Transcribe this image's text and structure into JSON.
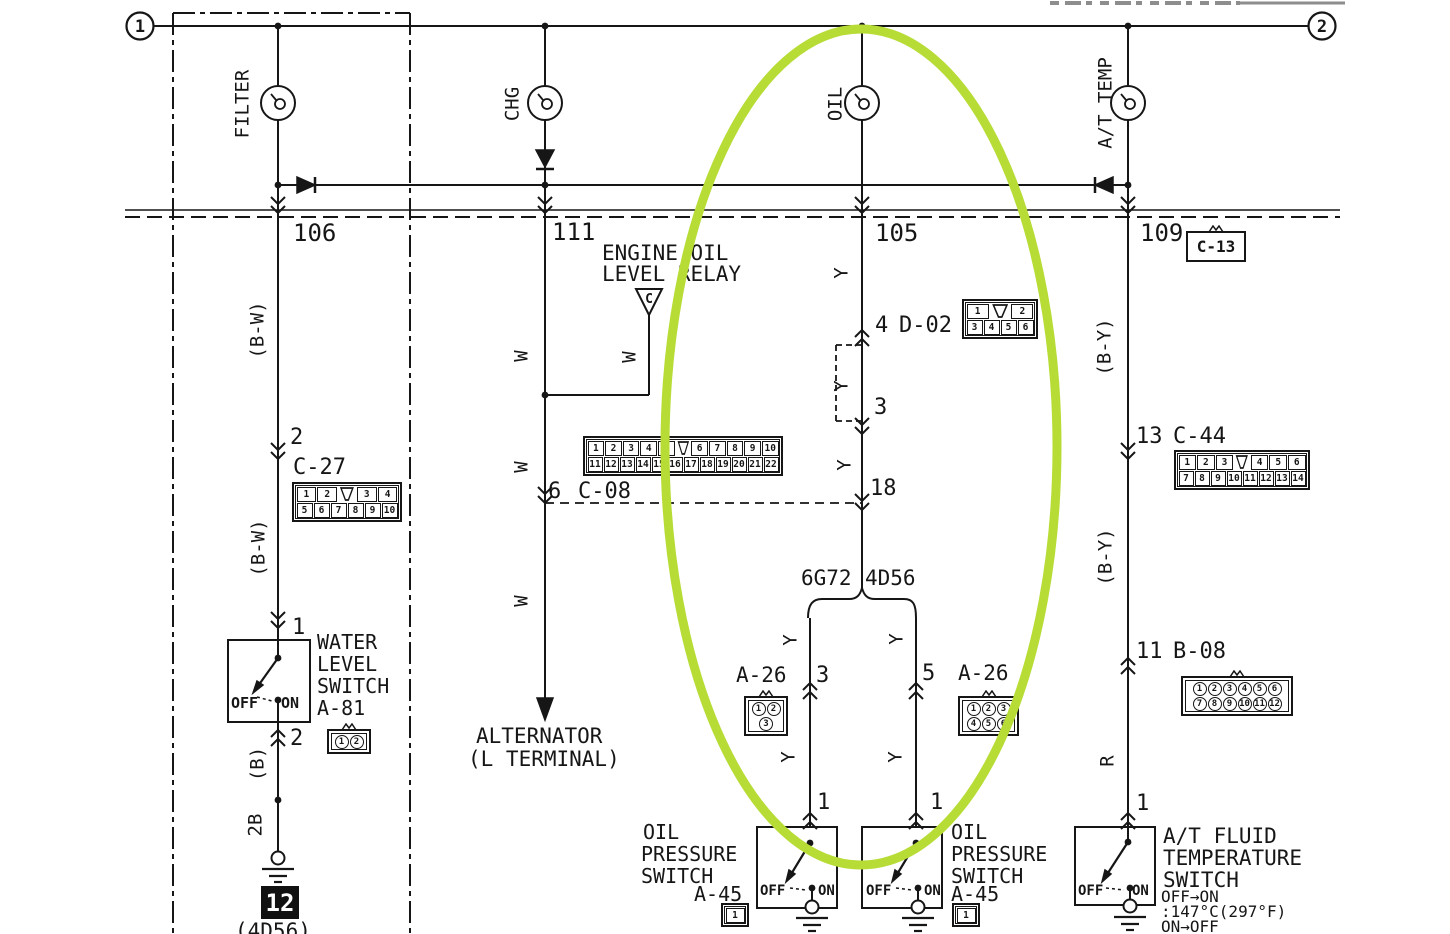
{
  "title": "Gauge circuit wiring diagram (FILTER / CHG / OIL / A-T TEMP indicators)",
  "colors": {
    "ink": "#161616",
    "background": "#ffffff",
    "highlight_green": "#b7dc36",
    "cropped_text_gray": "#8d8d8d"
  },
  "circuit_nodes": {
    "left": "1",
    "right": "2"
  },
  "highlight": {
    "shape": "ellipse",
    "color": "#b7dc36",
    "center_x": 861,
    "center_y": 447,
    "rx": 196,
    "ry": 418
  },
  "ground_ref": {
    "t": "12"
  },
  "labels": [
    {
      "n": "filter-gauge-label",
      "t": "FILTER",
      "x": 243,
      "y": 104,
      "s": 19,
      "rot": 1
    },
    {
      "n": "chg-gauge-label",
      "t": "CHG",
      "x": 513,
      "y": 104,
      "s": 19,
      "rot": 1
    },
    {
      "n": "oil-gauge-label",
      "t": "OIL",
      "x": 836,
      "y": 104,
      "s": 19,
      "rot": 1
    },
    {
      "n": "at-temp-gauge-label",
      "t": "A/T TEMP",
      "x": 1106,
      "y": 103,
      "s": 19,
      "rot": 1
    },
    {
      "n": "bus-pin-106",
      "t": "106",
      "x": 293,
      "y": 221,
      "s": 24
    },
    {
      "n": "bus-pin-111",
      "t": "111",
      "x": 552,
      "y": 220,
      "s": 24
    },
    {
      "n": "bus-pin-105",
      "t": "105",
      "x": 875,
      "y": 221,
      "s": 24
    },
    {
      "n": "bus-pin-109",
      "t": "109",
      "x": 1140,
      "y": 221,
      "s": 24
    },
    {
      "n": "wire-color-bw-upper",
      "t": "(B-W)",
      "x": 258,
      "y": 330,
      "s": 19,
      "rot": 1
    },
    {
      "n": "pin-2-c27",
      "t": "2",
      "x": 290,
      "y": 427,
      "s": 22
    },
    {
      "n": "connector-id-c27",
      "t": "C-27",
      "x": 293,
      "y": 457,
      "s": 22
    },
    {
      "n": "wire-color-bw-lower",
      "t": "(B-W)",
      "x": 259,
      "y": 548,
      "s": 19,
      "rot": 1
    },
    {
      "n": "pin-1-a81",
      "t": "1",
      "x": 292,
      "y": 617,
      "s": 22
    },
    {
      "n": "water-level-switch-name-1",
      "t": "WATER",
      "x": 317,
      "y": 632,
      "s": 20
    },
    {
      "n": "water-level-switch-name-2",
      "t": "LEVEL",
      "x": 317,
      "y": 654,
      "s": 20
    },
    {
      "n": "water-level-switch-name-3",
      "t": "SWITCH",
      "x": 317,
      "y": 676,
      "s": 20
    },
    {
      "n": "water-level-switch-id",
      "t": "A-81",
      "x": 317,
      "y": 698,
      "s": 20
    },
    {
      "n": "water-level-off",
      "t": "OFF",
      "x": 231,
      "y": 696,
      "s": 15,
      "w": 700
    },
    {
      "n": "water-level-on",
      "t": "ON",
      "x": 281,
      "y": 696,
      "s": 15,
      "w": 700
    },
    {
      "n": "pin-2-a81",
      "t": "2",
      "x": 290,
      "y": 728,
      "s": 22
    },
    {
      "n": "wire-color-b",
      "t": "(B)",
      "x": 258,
      "y": 764,
      "s": 19,
      "rot": 1
    },
    {
      "n": "wire-gauge-2b",
      "t": "2B",
      "x": 256,
      "y": 825,
      "s": 19,
      "rot": 1
    },
    {
      "n": "engine-code-4d56-bottom",
      "t": "(4D56)",
      "x": 235,
      "y": 921,
      "s": 21
    },
    {
      "n": "wire-color-w-1",
      "t": "W",
      "x": 522,
      "y": 356,
      "s": 19,
      "rot": 1
    },
    {
      "n": "wire-color-w-2",
      "t": "W",
      "x": 522,
      "y": 467,
      "s": 19,
      "rot": 1
    },
    {
      "n": "wire-color-w-3",
      "t": "W",
      "x": 522,
      "y": 601,
      "s": 19,
      "rot": 1
    },
    {
      "n": "wire-color-w-relay",
      "t": "W",
      "x": 630,
      "y": 357,
      "s": 19,
      "rot": 1
    },
    {
      "n": "engine-oil-level-relay-name-1",
      "t": "ENGINE OIL",
      "x": 602,
      "y": 243,
      "s": 21
    },
    {
      "n": "engine-oil-level-relay-name-2",
      "t": "LEVEL RELAY",
      "x": 602,
      "y": 264,
      "s": 21
    },
    {
      "n": "pin-6-c08",
      "t": "6",
      "x": 548,
      "y": 481,
      "s": 22
    },
    {
      "n": "connector-id-c08",
      "t": "C-08",
      "x": 578,
      "y": 481,
      "s": 22
    },
    {
      "n": "alternator-name-1",
      "t": "ALTERNATOR",
      "x": 476,
      "y": 726,
      "s": 21
    },
    {
      "n": "alternator-name-2",
      "t": "(L TERMINAL)",
      "x": 468,
      "y": 749,
      "s": 21
    },
    {
      "n": "wire-color-y-1",
      "t": "Y",
      "x": 842,
      "y": 273,
      "s": 19,
      "rot": 1
    },
    {
      "n": "pin-4-d02",
      "t": "4",
      "x": 875,
      "y": 315,
      "s": 22
    },
    {
      "n": "connector-id-d02",
      "t": "D-02",
      "x": 899,
      "y": 315,
      "s": 22
    },
    {
      "n": "wire-color-y-2",
      "t": "Y",
      "x": 842,
      "y": 386,
      "s": 19,
      "rot": 1
    },
    {
      "n": "pin-3-d02",
      "t": "3",
      "x": 874,
      "y": 397,
      "s": 22
    },
    {
      "n": "wire-color-y-3",
      "t": "Y",
      "x": 845,
      "y": 465,
      "s": 19,
      "rot": 1
    },
    {
      "n": "pin-18",
      "t": "18",
      "x": 870,
      "y": 478,
      "s": 22
    },
    {
      "n": "engine-code-6g72",
      "t": "6G72",
      "x": 801,
      "y": 568,
      "s": 21
    },
    {
      "n": "engine-code-4d56",
      "t": "4D56",
      "x": 865,
      "y": 568,
      "s": 21
    },
    {
      "n": "wire-color-y-4",
      "t": "Y",
      "x": 791,
      "y": 640,
      "s": 19,
      "rot": 1
    },
    {
      "n": "wire-color-y-5",
      "t": "Y",
      "x": 897,
      "y": 639,
      "s": 19,
      "rot": 1
    },
    {
      "n": "connector-id-a26-left",
      "t": "A-26",
      "x": 736,
      "y": 665,
      "s": 21
    },
    {
      "n": "pin-3-a26",
      "t": "3",
      "x": 816,
      "y": 665,
      "s": 22
    },
    {
      "n": "pin-5-a26",
      "t": "5",
      "x": 922,
      "y": 663,
      "s": 22
    },
    {
      "n": "connector-id-a26-right",
      "t": "A-26",
      "x": 958,
      "y": 663,
      "s": 21
    },
    {
      "n": "wire-color-y-6",
      "t": "Y",
      "x": 789,
      "y": 757,
      "s": 19,
      "rot": 1
    },
    {
      "n": "wire-color-y-7",
      "t": "Y",
      "x": 896,
      "y": 757,
      "s": 19,
      "rot": 1
    },
    {
      "n": "pin-1-oil-switch-left",
      "t": "1",
      "x": 817,
      "y": 792,
      "s": 22
    },
    {
      "n": "pin-1-oil-switch-right",
      "t": "1",
      "x": 930,
      "y": 792,
      "s": 22
    },
    {
      "n": "oil-switch-left-name-1",
      "t": "OIL",
      "x": 643,
      "y": 822,
      "s": 20
    },
    {
      "n": "oil-switch-left-name-2",
      "t": "PRESSURE",
      "x": 641,
      "y": 844,
      "s": 20
    },
    {
      "n": "oil-switch-left-name-3",
      "t": "SWITCH",
      "x": 641,
      "y": 866,
      "s": 20
    },
    {
      "n": "oil-switch-left-id",
      "t": "A-45",
      "x": 694,
      "y": 884,
      "s": 20
    },
    {
      "n": "oil-switch-left-off",
      "t": "OFF",
      "x": 760,
      "y": 884,
      "s": 14,
      "w": 700
    },
    {
      "n": "oil-switch-left-on",
      "t": "ON",
      "x": 818,
      "y": 884,
      "s": 14,
      "w": 700
    },
    {
      "n": "oil-switch-right-off",
      "t": "OFF",
      "x": 866,
      "y": 884,
      "s": 14,
      "w": 700
    },
    {
      "n": "oil-switch-right-on",
      "t": "ON",
      "x": 924,
      "y": 884,
      "s": 14,
      "w": 700
    },
    {
      "n": "oil-switch-right-name-1",
      "t": "OIL",
      "x": 951,
      "y": 822,
      "s": 20
    },
    {
      "n": "oil-switch-right-name-2",
      "t": "PRESSURE",
      "x": 951,
      "y": 844,
      "s": 20
    },
    {
      "n": "oil-switch-right-name-3",
      "t": "SWITCH",
      "x": 951,
      "y": 866,
      "s": 20
    },
    {
      "n": "oil-switch-right-id",
      "t": "A-45",
      "x": 951,
      "y": 884,
      "s": 20
    },
    {
      "n": "wire-color-by-upper",
      "t": "(B-Y)",
      "x": 1105,
      "y": 347,
      "s": 19,
      "rot": 1
    },
    {
      "n": "pin-13-c44",
      "t": "13",
      "x": 1136,
      "y": 426,
      "s": 22
    },
    {
      "n": "connector-id-c44",
      "t": "C-44",
      "x": 1173,
      "y": 426,
      "s": 22
    },
    {
      "n": "wire-color-by-lower",
      "t": "(B-Y)",
      "x": 1106,
      "y": 557,
      "s": 19,
      "rot": 1
    },
    {
      "n": "pin-11-b08",
      "t": "11",
      "x": 1136,
      "y": 641,
      "s": 22
    },
    {
      "n": "connector-id-b08",
      "t": "B-08",
      "x": 1173,
      "y": 641,
      "s": 22
    },
    {
      "n": "wire-color-r",
      "t": "R",
      "x": 1108,
      "y": 761,
      "s": 19,
      "rot": 1
    },
    {
      "n": "pin-1-atf-switch",
      "t": "1",
      "x": 1136,
      "y": 793,
      "s": 22
    },
    {
      "n": "atf-switch-off",
      "t": "OFF",
      "x": 1078,
      "y": 884,
      "s": 14,
      "w": 700
    },
    {
      "n": "atf-switch-on",
      "t": "ON",
      "x": 1132,
      "y": 884,
      "s": 14,
      "w": 700
    },
    {
      "n": "atf-switch-name-1",
      "t": "A/T FLUID",
      "x": 1163,
      "y": 826,
      "s": 21
    },
    {
      "n": "atf-switch-name-2",
      "t": "TEMPERATURE",
      "x": 1163,
      "y": 848,
      "s": 21
    },
    {
      "n": "atf-switch-name-3",
      "t": "SWITCH",
      "x": 1163,
      "y": 870,
      "s": 21
    },
    {
      "n": "atf-switch-note-1",
      "t": "OFF→ON",
      "x": 1161,
      "y": 889,
      "s": 16
    },
    {
      "n": "atf-switch-note-2",
      "t": ":147°C(297°F)",
      "x": 1161,
      "y": 904,
      "s": 16
    },
    {
      "n": "atf-switch-note-3",
      "t": "ON→OFF",
      "x": 1161,
      "y": 919,
      "s": 16
    }
  ],
  "connectors": [
    {
      "name": "C-27",
      "type": "grid",
      "x": 292,
      "y": 482,
      "cell": 17,
      "rows": [
        [
          "1",
          "2",
          "K",
          "3",
          "4"
        ],
        [
          "5",
          "6",
          "7",
          "8",
          "9",
          "10"
        ]
      ]
    },
    {
      "name": "C-08",
      "type": "grid",
      "x": 583,
      "y": 436,
      "cell": 16,
      "rows": [
        [
          "1",
          "2",
          "3",
          "4",
          "5",
          "K",
          "6",
          "7",
          "8",
          "9",
          "10"
        ],
        [
          "11",
          "12",
          "13",
          "14",
          "15",
          "16",
          "17",
          "18",
          "19",
          "20",
          "21",
          "22"
        ]
      ]
    },
    {
      "name": "D-02",
      "type": "grid",
      "x": 962,
      "y": 299,
      "cell": 17,
      "rows": [
        [
          "1",
          "K",
          "2"
        ],
        [
          "3",
          "4",
          "5",
          "6"
        ]
      ]
    },
    {
      "name": "C-44",
      "type": "grid",
      "x": 1174,
      "y": 450,
      "cell": 16,
      "rows": [
        [
          "1",
          "2",
          "3",
          "K",
          "4",
          "5",
          "6"
        ],
        [
          "7",
          "8",
          "9",
          "10",
          "11",
          "12",
          "13",
          "14"
        ]
      ]
    },
    {
      "name": "B-08",
      "type": "circle",
      "x": 1181,
      "y": 676,
      "rows": [
        [
          "1",
          "2",
          "3",
          "4",
          "5",
          "6"
        ],
        [
          "7",
          "8",
          "9",
          "10",
          "11",
          "12"
        ]
      ]
    },
    {
      "name": "A-26",
      "type": "circle",
      "x": 744,
      "y": 696,
      "rows": [
        [
          "1",
          "2"
        ],
        [
          "3"
        ]
      ]
    },
    {
      "name": "A-26",
      "type": "circle",
      "x": 958,
      "y": 696,
      "rows": [
        [
          "1",
          "2",
          "3"
        ],
        [
          "4",
          "5",
          "6"
        ]
      ]
    },
    {
      "name": "A-81",
      "type": "circle",
      "x": 327,
      "y": 729,
      "rows": [
        [
          "1",
          "2"
        ]
      ]
    },
    {
      "name": "A-45",
      "type": "grid",
      "x": 721,
      "y": 903,
      "cell": 20,
      "rows": [
        [
          "1"
        ]
      ]
    },
    {
      "name": "A-45",
      "type": "grid",
      "x": 952,
      "y": 903,
      "cell": 20,
      "rows": [
        [
          "1"
        ]
      ]
    },
    {
      "name": "C-13",
      "type": "label-box",
      "x": 1186,
      "y": 231,
      "w": 56,
      "h": 27,
      "t": "C-13"
    }
  ]
}
